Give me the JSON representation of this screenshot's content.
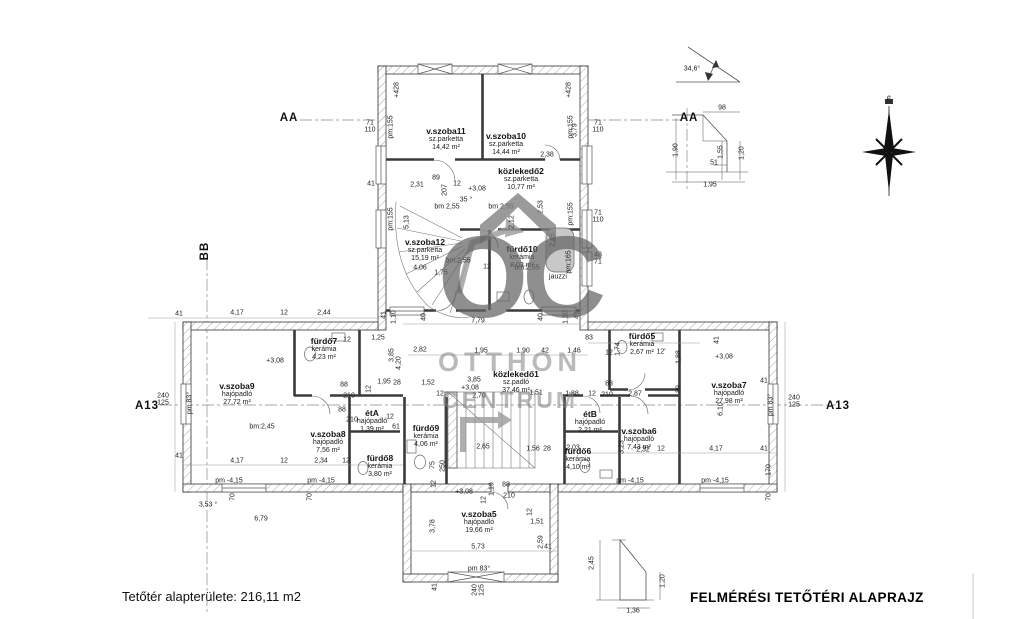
{
  "meta": {
    "title_left": "Tetőtér alapterülete: 216,11 m2",
    "title_right": "FELMÉRÉSI TETŐTÉRI ALAPRAJZ"
  },
  "watermark": {
    "monogram": "OC",
    "line1": "OTTHON",
    "line2": "CENTRUM"
  },
  "compass": {
    "label": "É"
  },
  "rooms": [
    {
      "name": "v.szoba11",
      "floor": "sz.parketta",
      "area": "14,42 m²",
      "x": 446,
      "y": 131
    },
    {
      "name": "v.szoba10",
      "floor": "sz.parketta",
      "area": "14,44 m²",
      "x": 506,
      "y": 136
    },
    {
      "name": "közlekedő2",
      "floor": "sz.parketta",
      "area": "10,77 m²",
      "x": 521,
      "y": 171
    },
    {
      "name": "v.szoba12",
      "floor": "sz.parketta",
      "area": "15,19 m²",
      "x": 425,
      "y": 242
    },
    {
      "name": "fürdő10",
      "floor": "kerámia",
      "area": "8,03 m²",
      "x": 522,
      "y": 249
    },
    {
      "name": "fürdő7",
      "floor": "kerámia",
      "area": "4,23 m²",
      "x": 324,
      "y": 341
    },
    {
      "name": "v.szoba9",
      "floor": "hajópadló",
      "area": "27,72 m²",
      "x": 237,
      "y": 386
    },
    {
      "name": "v.szoba8",
      "floor": "hajópadló",
      "area": "7,56 m²",
      "x": 328,
      "y": 434
    },
    {
      "name": "étA",
      "floor": "hajópadló",
      "area": "1,39 m²",
      "x": 372,
      "y": 413
    },
    {
      "name": "fürdő8",
      "floor": "kerámia",
      "area": "3,80 m²",
      "x": 380,
      "y": 458
    },
    {
      "name": "fürdő9",
      "floor": "kerámia",
      "area": "4,06 m²",
      "x": 426,
      "y": 428
    },
    {
      "name": "közlekedő1",
      "floor": "sz.padló",
      "area": "37,46 m²",
      "x": 516,
      "y": 374
    },
    {
      "name": "fürdő5",
      "floor": "kerámia",
      "area": "2,67 m²",
      "x": 642,
      "y": 336
    },
    {
      "name": "v.szoba7",
      "floor": "hajópadló",
      "area": "27,98 m²",
      "x": 729,
      "y": 385
    },
    {
      "name": "étB",
      "floor": "hajópadló",
      "area": "2,21 m²",
      "x": 590,
      "y": 414
    },
    {
      "name": "v.szoba6",
      "floor": "hajópadló",
      "area": "7,43 m²",
      "x": 639,
      "y": 431
    },
    {
      "name": "fürdő6",
      "floor": "kerámia",
      "area": "4,10 m²",
      "x": 578,
      "y": 451
    },
    {
      "name": "v.szoba5",
      "floor": "hajópadló",
      "area": "19,66 m²",
      "x": 479,
      "y": 514
    }
  ],
  "markers": [
    {
      "t": "AA",
      "x": 289,
      "y": 118
    },
    {
      "t": "AA",
      "x": 689,
      "y": 118
    },
    {
      "t": "BB",
      "x": 205,
      "y": 251,
      "r": 1
    },
    {
      "t": "A13",
      "x": 147,
      "y": 406
    },
    {
      "t": "A13",
      "x": 838,
      "y": 406
    }
  ],
  "dims": [
    {
      "t": "+428",
      "x": 397,
      "y": 90,
      "r": 1
    },
    {
      "t": "+428",
      "x": 569,
      "y": 90,
      "r": 1
    },
    {
      "t": "71\n110",
      "x": 370,
      "y": 127
    },
    {
      "t": "71\n110",
      "x": 598,
      "y": 127
    },
    {
      "t": "71\n110",
      "x": 598,
      "y": 217
    },
    {
      "t": "48\n71",
      "x": 598,
      "y": 259
    },
    {
      "t": "41",
      "x": 371,
      "y": 184
    },
    {
      "t": "pm:155",
      "x": 391,
      "y": 127,
      "r": 1
    },
    {
      "t": "pm:155",
      "x": 391,
      "y": 219,
      "r": 1
    },
    {
      "t": "pm:155",
      "x": 571,
      "y": 127,
      "r": 1
    },
    {
      "t": "pm:155",
      "x": 571,
      "y": 214,
      "r": 1
    },
    {
      "t": "pm:165",
      "x": 569,
      "y": 262,
      "r": 1
    },
    {
      "t": "jauzzi",
      "x": 558,
      "y": 277
    },
    {
      "t": "bm 2,55",
      "x": 447,
      "y": 207
    },
    {
      "t": "bm 2,55",
      "x": 501,
      "y": 207
    },
    {
      "t": "2,38",
      "x": 547,
      "y": 155
    },
    {
      "t": "3,79",
      "x": 575,
      "y": 130,
      "r": 1
    },
    {
      "t": "2,31",
      "x": 417,
      "y": 185
    },
    {
      "t": "89",
      "x": 436,
      "y": 178
    },
    {
      "t": "207",
      "x": 445,
      "y": 190,
      "r": 1
    },
    {
      "t": "12",
      "x": 457,
      "y": 184
    },
    {
      "t": "+3,08",
      "x": 477,
      "y": 189
    },
    {
      "t": "35 °",
      "x": 466,
      "y": 200
    },
    {
      "t": "2,53",
      "x": 541,
      "y": 207,
      "r": 1
    },
    {
      "t": "5,13",
      "x": 407,
      "y": 222,
      "r": 1
    },
    {
      "t": "2,12",
      "x": 512,
      "y": 222,
      "r": 1
    },
    {
      "t": "4,06",
      "x": 420,
      "y": 268
    },
    {
      "t": "1,75",
      "x": 441,
      "y": 273
    },
    {
      "t": "12",
      "x": 487,
      "y": 267
    },
    {
      "t": "bm:2,55",
      "x": 458,
      "y": 261
    },
    {
      "t": "bm:2,55",
      "x": 527,
      "y": 268
    },
    {
      "t": "2,45",
      "x": 553,
      "y": 240,
      "r": 1
    },
    {
      "t": "7,79",
      "x": 478,
      "y": 321
    },
    {
      "t": "41",
      "x": 384,
      "y": 315,
      "r": 1
    },
    {
      "t": "1,10",
      "x": 394,
      "y": 317,
      "r": 1
    },
    {
      "t": "40",
      "x": 424,
      "y": 317,
      "r": 1
    },
    {
      "t": "40",
      "x": 541,
      "y": 317,
      "r": 1
    },
    {
      "t": "1,10",
      "x": 566,
      "y": 317,
      "r": 1
    },
    {
      "t": "41",
      "x": 577,
      "y": 315,
      "r": 1
    },
    {
      "t": "41",
      "x": 179,
      "y": 314
    },
    {
      "t": "4,17",
      "x": 237,
      "y": 313
    },
    {
      "t": "12",
      "x": 284,
      "y": 313
    },
    {
      "t": "2,44",
      "x": 324,
      "y": 313
    },
    {
      "t": "1,25",
      "x": 378,
      "y": 338
    },
    {
      "t": "12",
      "x": 347,
      "y": 340
    },
    {
      "t": "+3,08",
      "x": 275,
      "y": 361
    },
    {
      "t": "3,85",
      "x": 392,
      "y": 355,
      "r": 1
    },
    {
      "t": "4,20",
      "x": 399,
      "y": 363,
      "r": 1
    },
    {
      "t": "2,82",
      "x": 420,
      "y": 350
    },
    {
      "t": "1,95",
      "x": 481,
      "y": 351
    },
    {
      "t": "1,90",
      "x": 523,
      "y": 351
    },
    {
      "t": "42",
      "x": 545,
      "y": 351
    },
    {
      "t": "1,46",
      "x": 574,
      "y": 351
    },
    {
      "t": "83",
      "x": 589,
      "y": 338
    },
    {
      "t": "12",
      "x": 609,
      "y": 353
    },
    {
      "t": "1,74",
      "x": 618,
      "y": 349,
      "r": 1
    },
    {
      "t": "12'",
      "x": 661,
      "y": 352
    },
    {
      "t": "1,88",
      "x": 679,
      "y": 357,
      "r": 1
    },
    {
      "t": "41",
      "x": 717,
      "y": 340,
      "r": 1
    },
    {
      "t": "+3,08",
      "x": 724,
      "y": 357
    },
    {
      "t": "28",
      "x": 397,
      "y": 383
    },
    {
      "t": "1,52",
      "x": 428,
      "y": 383
    },
    {
      "t": "12",
      "x": 440,
      "y": 394
    },
    {
      "t": "3,85",
      "x": 474,
      "y": 380
    },
    {
      "t": "+3,08",
      "x": 470,
      "y": 388
    },
    {
      "t": "2,70",
      "x": 479,
      "y": 396
    },
    {
      "t": "1,51",
      "x": 536,
      "y": 393
    },
    {
      "t": "1,88",
      "x": 572,
      "y": 394
    },
    {
      "t": "12",
      "x": 592,
      "y": 394
    },
    {
      "t": "210",
      "x": 607,
      "y": 395
    },
    {
      "t": "2,87",
      "x": 635,
      "y": 394
    },
    {
      "t": "88",
      "x": 609,
      "y": 384
    },
    {
      "t": "89",
      "x": 679,
      "y": 389,
      "r": 1
    },
    {
      "t": "1,95",
      "x": 384,
      "y": 382
    },
    {
      "t": "88",
      "x": 344,
      "y": 385
    },
    {
      "t": "210",
      "x": 349,
      "y": 396
    },
    {
      "t": "88",
      "x": 342,
      "y": 410
    },
    {
      "t": "210",
      "x": 352,
      "y": 420
    },
    {
      "t": "12",
      "x": 369,
      "y": 389,
      "r": 1
    },
    {
      "t": "12",
      "x": 390,
      "y": 417
    },
    {
      "t": "61",
      "x": 396,
      "y": 427
    },
    {
      "t": "75",
      "x": 433,
      "y": 465,
      "r": 1
    },
    {
      "t": "250",
      "x": 443,
      "y": 466,
      "r": 1
    },
    {
      "t": "2,65",
      "x": 483,
      "y": 447
    },
    {
      "t": "1,56",
      "x": 533,
      "y": 449
    },
    {
      "t": "28",
      "x": 547,
      "y": 449
    },
    {
      "t": "bm:2,45",
      "x": 262,
      "y": 427
    },
    {
      "t": "41",
      "x": 764,
      "y": 381
    },
    {
      "t": "6,10",
      "x": 721,
      "y": 409,
      "r": 1
    },
    {
      "t": "pm 83°",
      "x": 771,
      "y": 405,
      "r": 1
    },
    {
      "t": "240\n125",
      "x": 794,
      "y": 402
    },
    {
      "t": "3,23",
      "x": 622,
      "y": 447,
      "r": 1
    },
    {
      "t": "2,32",
      "x": 643,
      "y": 450
    },
    {
      "t": "12",
      "x": 661,
      "y": 449
    },
    {
      "t": "4,17",
      "x": 716,
      "y": 449
    },
    {
      "t": "41",
      "x": 764,
      "y": 449
    },
    {
      "t": "2,03",
      "x": 573,
      "y": 448
    },
    {
      "t": "pm -4,15",
      "x": 630,
      "y": 481
    },
    {
      "t": "pm -4,15",
      "x": 715,
      "y": 481
    },
    {
      "t": "170",
      "x": 769,
      "y": 470,
      "r": 1
    },
    {
      "t": "70",
      "x": 769,
      "y": 497,
      "r": 1
    },
    {
      "t": "4,17",
      "x": 237,
      "y": 461
    },
    {
      "t": "12",
      "x": 284,
      "y": 461
    },
    {
      "t": "2,34",
      "x": 321,
      "y": 461
    },
    {
      "t": "12",
      "x": 346,
      "y": 461
    },
    {
      "t": "pm -4,15",
      "x": 229,
      "y": 481
    },
    {
      "t": "pm -4,15",
      "x": 321,
      "y": 481
    },
    {
      "t": "70",
      "x": 233,
      "y": 497,
      "r": 1
    },
    {
      "t": "70",
      "x": 310,
      "y": 497,
      "r": 1
    },
    {
      "t": "3,53 °",
      "x": 208,
      "y": 505
    },
    {
      "t": "6,79",
      "x": 261,
      "y": 519
    },
    {
      "t": "41",
      "x": 179,
      "y": 456
    },
    {
      "t": "240\n125",
      "x": 163,
      "y": 400
    },
    {
      "t": "pm 83°",
      "x": 190,
      "y": 403,
      "r": 1
    },
    {
      "t": "12",
      "x": 434,
      "y": 484,
      "r": 1
    },
    {
      "t": "+3,08",
      "x": 464,
      "y": 492
    },
    {
      "t": "88",
      "x": 506,
      "y": 485
    },
    {
      "t": "210",
      "x": 509,
      "y": 496
    },
    {
      "t": "1,19",
      "x": 492,
      "y": 489,
      "r": 1
    },
    {
      "t": "12",
      "x": 484,
      "y": 500,
      "r": 1
    },
    {
      "t": "12",
      "x": 530,
      "y": 512,
      "r": 1
    },
    {
      "t": "1,51",
      "x": 537,
      "y": 522
    },
    {
      "t": "3,78",
      "x": 433,
      "y": 526,
      "r": 1
    },
    {
      "t": "5,73",
      "x": 478,
      "y": 547
    },
    {
      "t": "2,59",
      "x": 541,
      "y": 542,
      "r": 1
    },
    {
      "t": "41",
      "x": 548,
      "y": 547
    },
    {
      "t": "pm 83°",
      "x": 479,
      "y": 569
    },
    {
      "t": "41",
      "x": 435,
      "y": 587,
      "r": 1
    },
    {
      "t": "240\n125",
      "x": 479,
      "y": 590,
      "r": 1
    },
    {
      "t": "34,6°",
      "x": 692,
      "y": 69
    },
    {
      "t": "98",
      "x": 722,
      "y": 108
    },
    {
      "t": "1,90",
      "x": 676,
      "y": 150,
      "r": 1
    },
    {
      "t": "1,55",
      "x": 721,
      "y": 152,
      "r": 1
    },
    {
      "t": "1,20",
      "x": 742,
      "y": 153,
      "r": 1
    },
    {
      "t": "51",
      "x": 714,
      "y": 163
    },
    {
      "t": "1,95",
      "x": 710,
      "y": 185
    },
    {
      "t": "2,45",
      "x": 592,
      "y": 563,
      "r": 1
    },
    {
      "t": "1,20",
      "x": 663,
      "y": 581,
      "r": 1
    },
    {
      "t": "1,36",
      "x": 633,
      "y": 611
    },
    {
      "t": "É",
      "x": 889,
      "y": 100
    }
  ]
}
